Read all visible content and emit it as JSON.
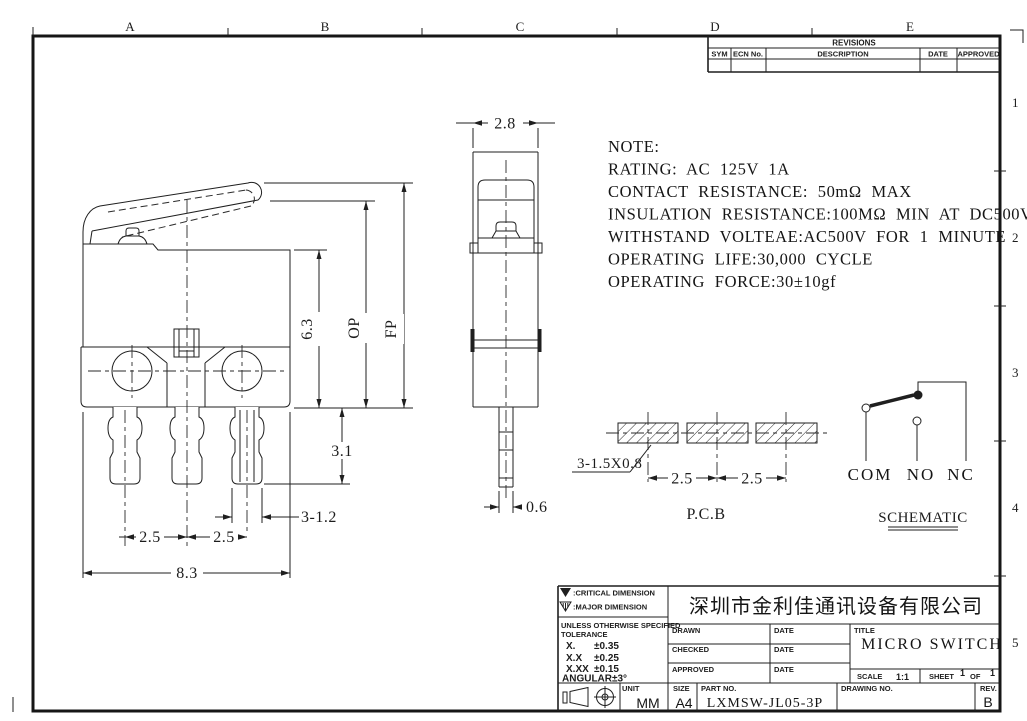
{
  "colors": {
    "ink": "#1f1f1f",
    "background": "#ffffff"
  },
  "frame": {
    "cols": [
      "A",
      "B",
      "C",
      "D",
      "E"
    ],
    "rows": [
      "1",
      "2",
      "3",
      "4",
      "5"
    ]
  },
  "revisions": {
    "title": "REVISIONS",
    "col_sym": "SYM",
    "col_ecn": "ECN No.",
    "col_desc": "DESCRIPTION",
    "col_date": "DATE",
    "col_approved": "APPROVED"
  },
  "note": {
    "l1": "NOTE:",
    "l2": "RATING: AC 125V 1A",
    "l3": "CONTACT RESISTANCE: 50mΩ MAX",
    "l4": "INSULATION RESISTANCE:100MΩ MIN AT DC500V",
    "l5": "WITHSTAND VOLTEAE:AC500V FOR 1 MINUTE",
    "l6": "OPERATING LIFE:30,000 CYCLE",
    "l7": "OPERATING FORCE:30±10gf"
  },
  "side_view": {
    "dim_height": "6.3",
    "dim_op": "OP",
    "dim_fp": "FP",
    "dim_pin_len": "3.1",
    "dim_pin_width": "3-1.2",
    "dim_pitch_a": "2.5",
    "dim_pitch_b": "2.5",
    "dim_width": "8.3"
  },
  "front_view": {
    "dim_width": "2.8",
    "dim_pin": "0.6"
  },
  "pcb": {
    "slot_callout": "3-1.5X0.8",
    "dim_pitch_a": "2.5",
    "dim_pitch_b": "2.5",
    "label": "P.C.B"
  },
  "schematic": {
    "com": "COM",
    "no": "NO",
    "nc": "NC",
    "label": "SCHEMATIC"
  },
  "title_block": {
    "critical_label": ":CRITICAL DIMENSION",
    "major_label": ":MAJOR DIMENSION",
    "tol_header1": "UNLESS OTHERWISE SPECIFIED",
    "tol_header2": "TOLERANCE",
    "tol_x_label": "X.",
    "tol_x": "±0.35",
    "tol_xx_label": "X.X",
    "tol_xx": "±0.25",
    "tol_xxx_label": "X.XX",
    "tol_xxx": "±0.15",
    "tol_ang_label": "ANGULAR",
    "tol_ang": "±3°",
    "company": "深圳市金利佳通讯设备有限公司",
    "drawn_label": "DRAWN",
    "checked_label": "CHECKED",
    "approved_label": "APPROVED",
    "date1": "DATE",
    "date2": "DATE",
    "date3": "DATE",
    "title_label": "TITLE",
    "title": "MICRO SWITCH",
    "scale_label": "SCALE",
    "scale": "1:1",
    "sheet_label": "SHEET",
    "sheet_num": "1",
    "of_label": "OF",
    "sheet_total": "1",
    "unit_label": "UNIT",
    "unit": "MM",
    "size_label": "SIZE",
    "size": "A4",
    "part_label": "PART NO.",
    "part_no": "LXMSW-JL05-3P",
    "drawing_label": "DRAWING NO.",
    "rev_label": "REV.",
    "rev": "B"
  }
}
